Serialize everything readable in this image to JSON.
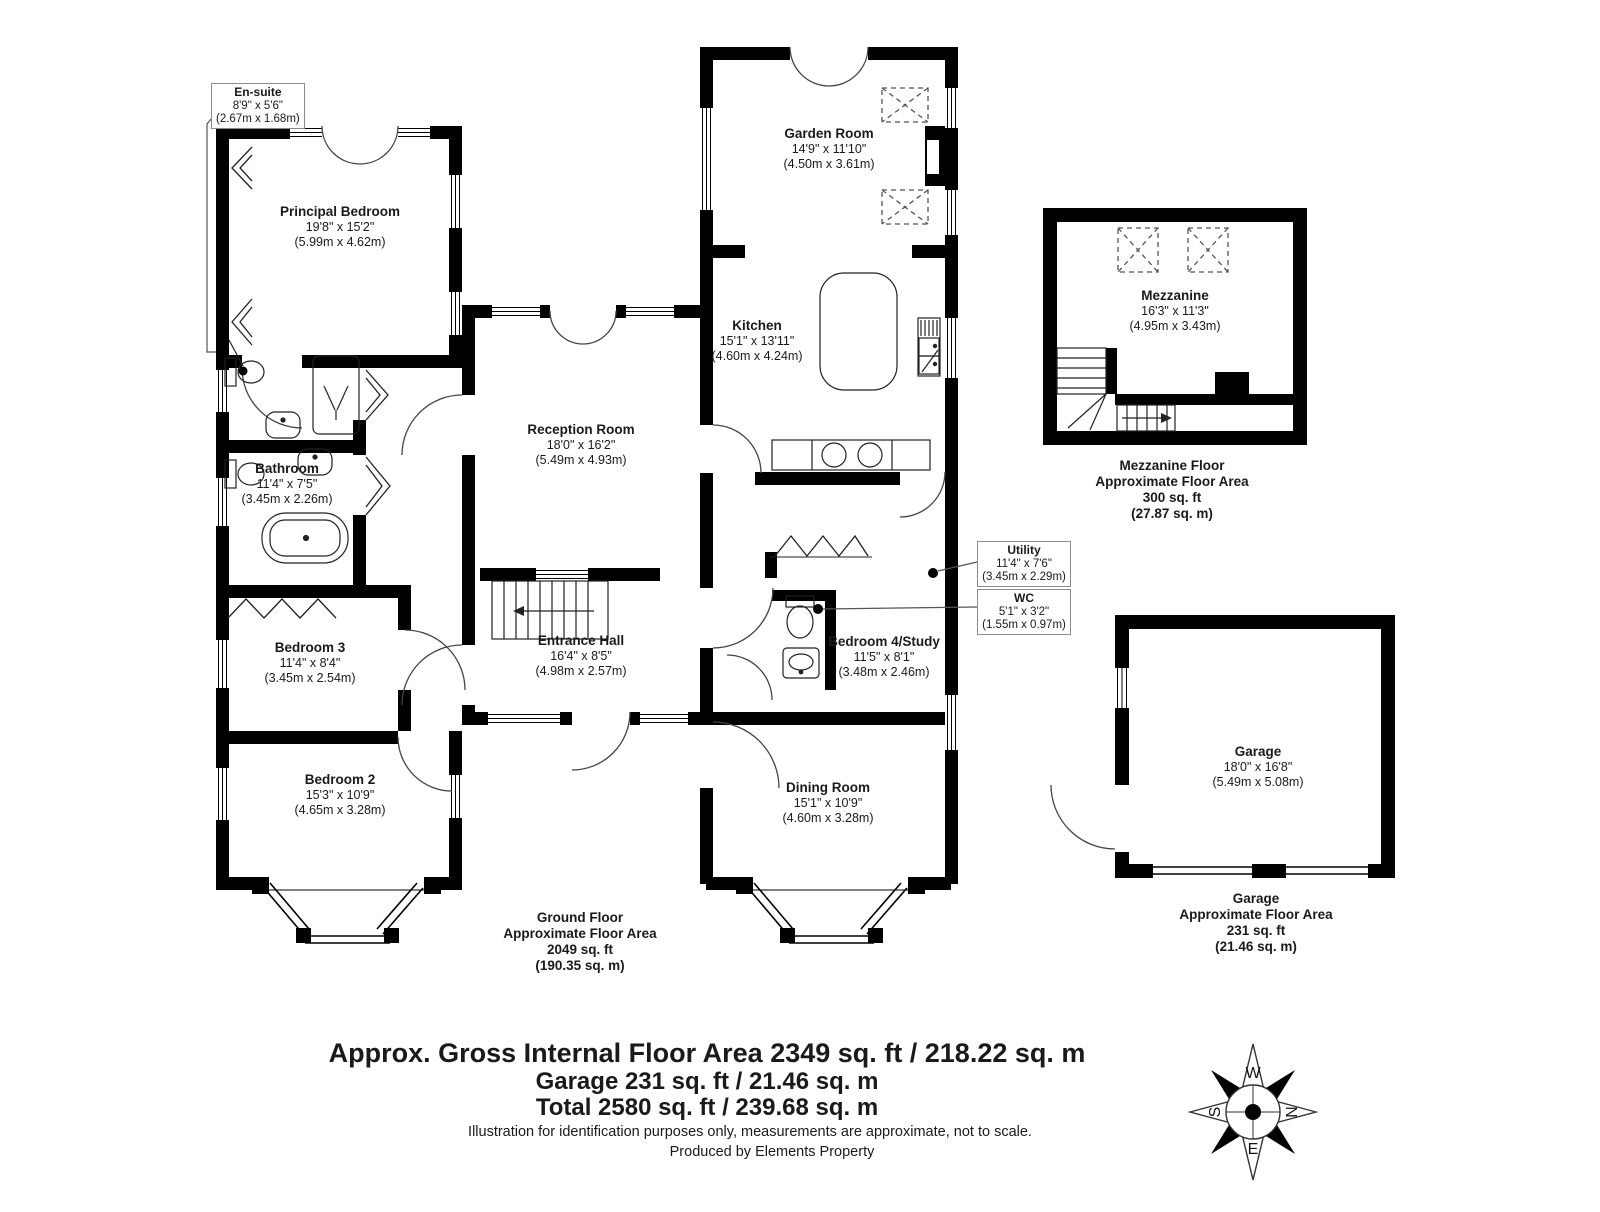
{
  "rooms": {
    "ensuite": {
      "name": "En-suite",
      "imperial": "8'9\" x 5'6\"",
      "metric": "(2.67m x 1.68m)"
    },
    "principal_bedroom": {
      "name": "Principal Bedroom",
      "imperial": "19'8\" x 15'2\"",
      "metric": "(5.99m x 4.62m)"
    },
    "garden_room": {
      "name": "Garden Room",
      "imperial": "14'9\" x 11'10\"",
      "metric": "(4.50m x 3.61m)"
    },
    "kitchen": {
      "name": "Kitchen",
      "imperial": "15'1\" x 13'11\"",
      "metric": "(4.60m x 4.24m)"
    },
    "reception_room": {
      "name": "Reception Room",
      "imperial": "18'0\" x 16'2\"",
      "metric": "(5.49m x 4.93m)"
    },
    "bathroom": {
      "name": "Bathroom",
      "imperial": "11'4\" x 7'5\"",
      "metric": "(3.45m x 2.26m)"
    },
    "bedroom3": {
      "name": "Bedroom 3",
      "imperial": "11'4\" x 8'4\"",
      "metric": "(3.45m x 2.54m)"
    },
    "entrance_hall": {
      "name": "Entrance Hall",
      "imperial": "16'4\" x 8'5\"",
      "metric": "(4.98m x 2.57m)"
    },
    "utility": {
      "name": "Utility",
      "imperial": "11'4\" x 7'6\"",
      "metric": "(3.45m x 2.29m)"
    },
    "wc": {
      "name": "WC",
      "imperial": "5'1\" x 3'2\"",
      "metric": "(1.55m x 0.97m)"
    },
    "bedroom4_study": {
      "name": "Bedroom 4/Study",
      "imperial": "11'5\" x 8'1\"",
      "metric": "(3.48m x 2.46m)"
    },
    "bedroom2": {
      "name": "Bedroom 2",
      "imperial": "15'3\" x 10'9\"",
      "metric": "(4.65m x 3.28m)"
    },
    "dining_room": {
      "name": "Dining Room",
      "imperial": "15'1\" x 10'9\"",
      "metric": "(4.60m x 3.28m)"
    },
    "mezzanine": {
      "name": "Mezzanine",
      "imperial": "16'3\" x 11'3\"",
      "metric": "(4.95m x 3.43m)"
    },
    "garage": {
      "name": "Garage",
      "imperial": "18'0\" x 16'8\"",
      "metric": "(5.49m x 5.08m)"
    }
  },
  "captions": {
    "ground_floor": {
      "l1": "Ground Floor",
      "l2": "Approximate Floor Area",
      "l3": "2049 sq. ft",
      "l4": "(190.35 sq. m)"
    },
    "mezzanine_floor": {
      "l1": "Mezzanine Floor",
      "l2": "Approximate Floor Area",
      "l3": "300 sq. ft",
      "l4": "(27.87 sq. m)"
    },
    "garage_floor": {
      "l1": "Garage",
      "l2": "Approximate Floor Area",
      "l3": "231 sq. ft",
      "l4": "(21.46 sq. m)"
    }
  },
  "summary": {
    "line1": "Approx. Gross Internal Floor Area 2349 sq. ft / 218.22 sq. m",
    "line2": "Garage 231 sq. ft / 21.46 sq. m",
    "line3": "Total 2580 sq. ft / 239.68 sq. m",
    "disclaimer": "Illustration for identification purposes only, measurements are approximate, not to scale.",
    "producer": "Produced by Elements Property"
  },
  "compass": {
    "north": "N",
    "east": "E",
    "south": "S",
    "west": "W"
  },
  "colors": {
    "wall": "#000000",
    "line": "#333333",
    "leader": "#555555",
    "text": "#1a1a1a"
  }
}
